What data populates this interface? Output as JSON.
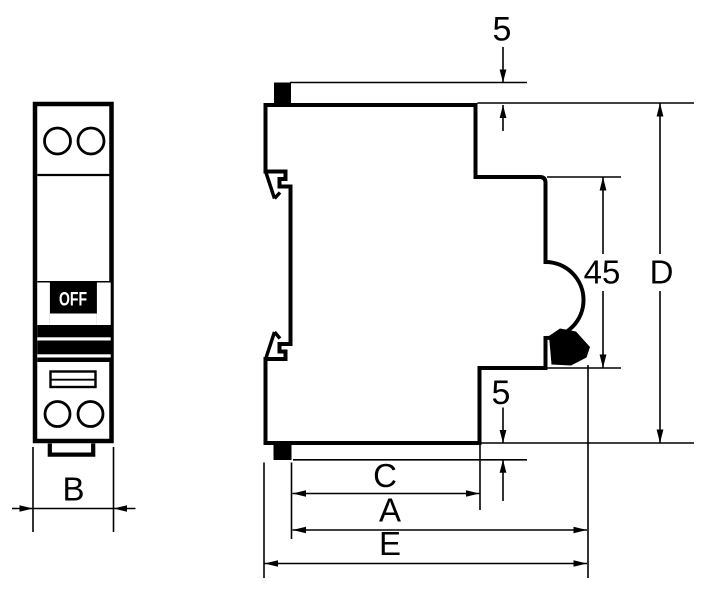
{
  "front_view": {
    "toggle_state": "OFF",
    "width_dim": "B"
  },
  "side_view": {
    "top_protrusion_dim": "5",
    "bottom_protrusion_dim": "5",
    "front_section_height": "45",
    "overall_height_dim": "D",
    "front_depth_dim": "C",
    "body_depth_dim": "A",
    "overall_depth_dim": "E"
  },
  "colors": {
    "line": "#000000",
    "background": "#ffffff",
    "toggle_fill": "#000000",
    "toggle_text": "#ffffff"
  }
}
